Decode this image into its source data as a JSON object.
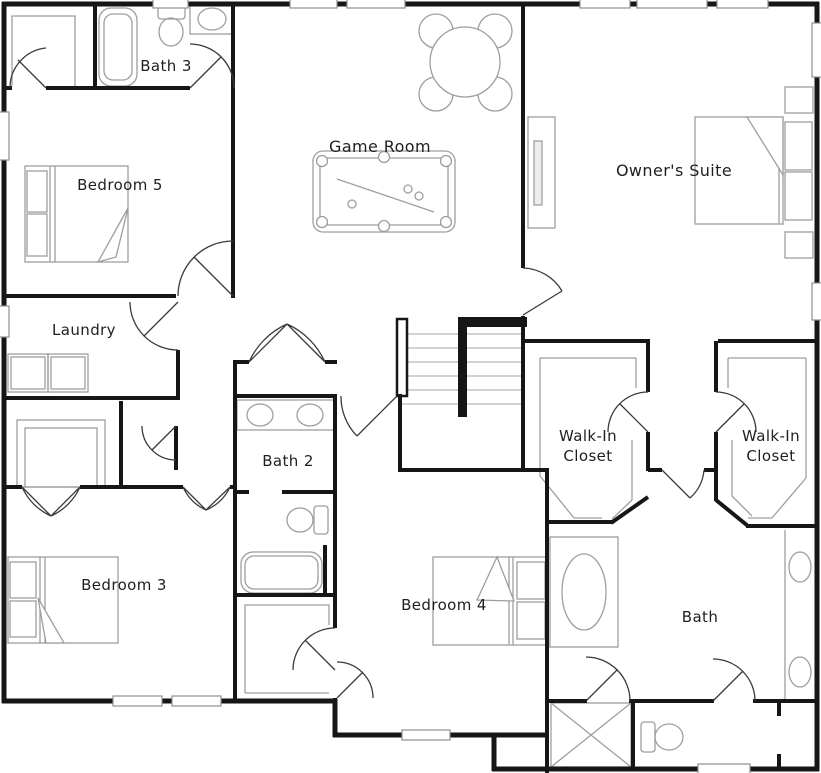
{
  "plan_title": "Floor plan",
  "colors": {
    "background": "#ffffff",
    "wall": "#161616",
    "fixture": "#9e9e9e",
    "door": "#3a3a3a",
    "stair_tread": "#c4c4c4",
    "window_frame": "#909090",
    "label_text": "#1f1f1f"
  },
  "rooms": {
    "bath3": {
      "label": "Bath 3"
    },
    "bedroom5": {
      "label": "Bedroom 5"
    },
    "game_room": {
      "label": "Game Room"
    },
    "owners_suite": {
      "label": "Owner's Suite"
    },
    "laundry": {
      "label": "Laundry"
    },
    "bath2": {
      "label": "Bath 2"
    },
    "walk_in_closet_left": {
      "line1": "Walk-In",
      "line2": "Closet"
    },
    "walk_in_closet_right": {
      "line1": "Walk-In",
      "line2": "Closet"
    },
    "bedroom3": {
      "label": "Bedroom 3"
    },
    "bedroom4": {
      "label": "Bedroom 4"
    },
    "bath": {
      "label": "Bath"
    }
  },
  "fixtures": {
    "bath3": [
      "bathtub",
      "toilet",
      "sink"
    ],
    "bedroom5": [
      "bed",
      "closet-shelves"
    ],
    "game_room": [
      "round-table-with-chairs",
      "pool-table"
    ],
    "owners_suite": [
      "bed",
      "nightstands",
      "media-console"
    ],
    "laundry": [
      "washer",
      "dryer"
    ],
    "bath2": [
      "double-vanity",
      "toilet",
      "bathtub",
      "linen-closet"
    ],
    "bedroom3": [
      "bed"
    ],
    "bedroom4": [
      "bed"
    ],
    "bath": [
      "soaking-tub",
      "double-vanity",
      "shower",
      "toilet"
    ],
    "hall": [
      "staircase"
    ]
  }
}
